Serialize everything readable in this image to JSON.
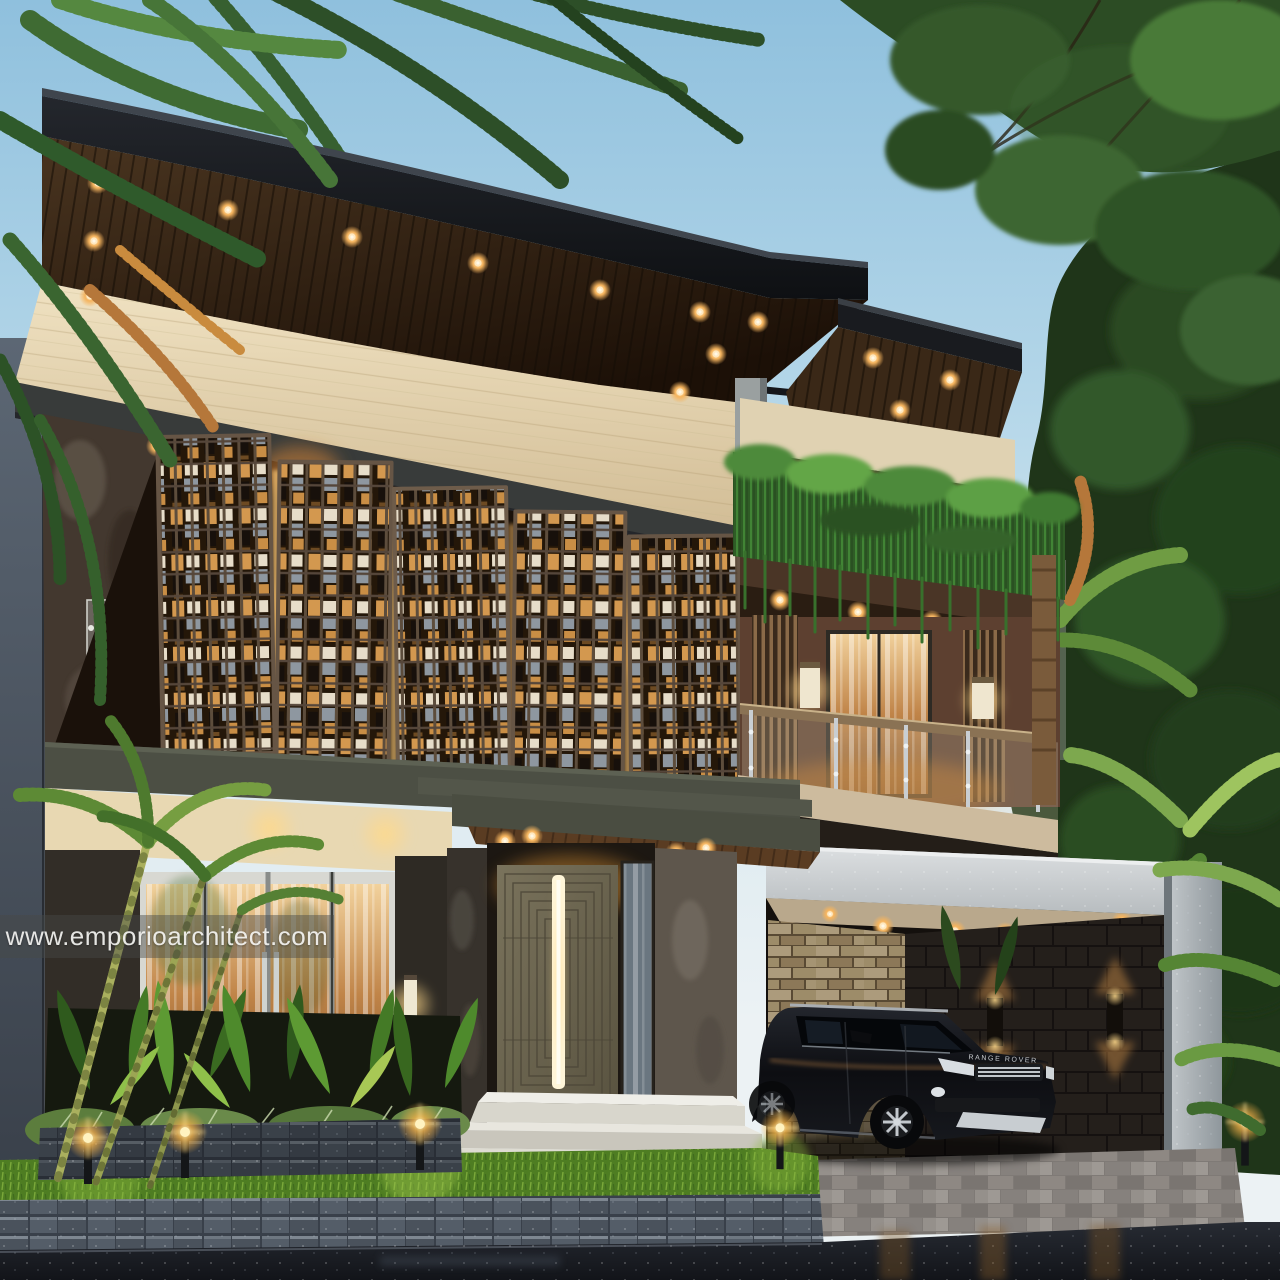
{
  "page": {
    "title": "Modern two-storey tropical house exterior render at dusk"
  },
  "watermark": {
    "text": "www.emporioarchitect.com"
  },
  "vehicle": {
    "badge": "RANGE ROVER",
    "description": "black SUV parked in carport"
  },
  "scene": {
    "time_of_day": "dusk",
    "subject": "two-storey modern tropical house front view",
    "elements": [
      "cantilevered dark roof with timber plank soffit and recessed downlights",
      "cream travertine wall band",
      "five timber lattice screen panels over warm-lit glazing",
      "dark natural stone feature wall with glass signage panel",
      "upper balcony with glass railing, curtained door and cream wall sconces",
      "hanging vine hedge over balcony parapet",
      "black steel pergola and round steel column",
      "white concrete double carport with stacked-stone and charcoal walls",
      "bronze pivot front door with vertical LED handle",
      "sliding glass doors with warm interior glow",
      "tropical planter bed with garden bollard lights",
      "grass strip, stone block retaining wall and wet dark driveway",
      "overhanging trees and palm fronds"
    ],
    "downlight_count_main_roof": 11,
    "bollard_light_count": 5
  },
  "palette": {
    "sky_top": "#8fc0dd",
    "sky_low": "#ecf2f4",
    "roof_fascia": "#16181c",
    "soffit_wood": "#3a2817",
    "downlight_glow": "#ffd9a0",
    "travertine": "#e6d9b8",
    "lattice_frame": "#5d4d3c",
    "lattice_warm": "#d49a55",
    "stone_feature": "#43382f",
    "olive_band": "#4c4f44",
    "door_bronze": "#6e6a52",
    "led_strip": "#fff3d2",
    "balcony_brown": "#5d4030",
    "hedge_green": "#2f5c26",
    "carport_white": "#cdd1d3",
    "stacked_stone": "#d6c49e",
    "charcoal_wall": "#241f1b",
    "grass": "#55842a",
    "block_wall": "#454d57",
    "driveway": "#1b1e23",
    "foliage_dark": "#1f3519"
  }
}
